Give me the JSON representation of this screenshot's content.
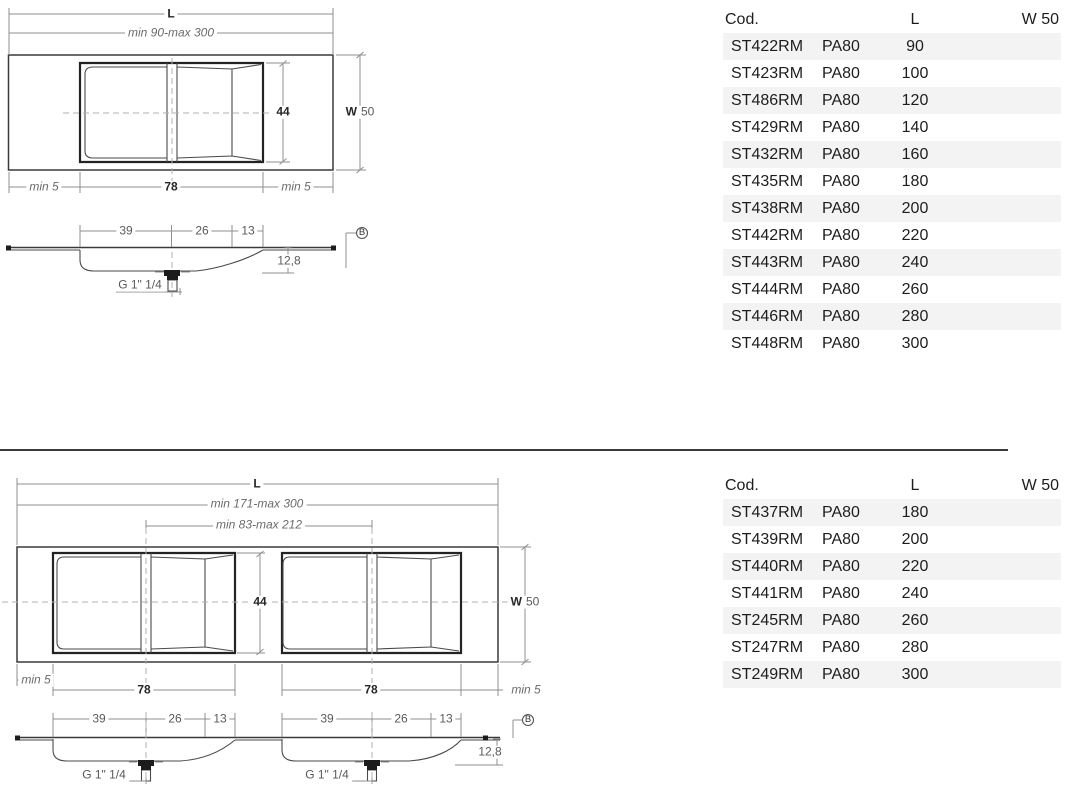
{
  "sections": [
    {
      "name": "single-basin",
      "drawing": {
        "plan": {
          "overall_length_label": "L",
          "length_range": "min 90-max 300",
          "basin_depth": "44",
          "width_label": "W",
          "width_value": "50",
          "left_margin": "min 5",
          "basin_width": "78",
          "right_margin": "min 5"
        },
        "section_view": {
          "dims": [
            "39",
            "26",
            "13"
          ],
          "thickness": "12,8",
          "drain_label": "G 1\" 1/4",
          "detail_callout": "B"
        }
      },
      "table": {
        "headers": {
          "code": "Cod.",
          "length": "L",
          "width": "W 50"
        },
        "rows": [
          {
            "code": "ST422RM",
            "series": "PA80",
            "length": "90"
          },
          {
            "code": "ST423RM",
            "series": "PA80",
            "length": "100"
          },
          {
            "code": "ST486RM",
            "series": "PA80",
            "length": "120"
          },
          {
            "code": "ST429RM",
            "series": "PA80",
            "length": "140"
          },
          {
            "code": "ST432RM",
            "series": "PA80",
            "length": "160"
          },
          {
            "code": "ST435RM",
            "series": "PA80",
            "length": "180"
          },
          {
            "code": "ST438RM",
            "series": "PA80",
            "length": "200"
          },
          {
            "code": "ST442RM",
            "series": "PA80",
            "length": "220"
          },
          {
            "code": "ST443RM",
            "series": "PA80",
            "length": "240"
          },
          {
            "code": "ST444RM",
            "series": "PA80",
            "length": "260"
          },
          {
            "code": "ST446RM",
            "series": "PA80",
            "length": "280"
          },
          {
            "code": "ST448RM",
            "series": "PA80",
            "length": "300"
          }
        ]
      }
    },
    {
      "name": "double-basin",
      "drawing": {
        "plan": {
          "overall_length_label": "L",
          "length_range": "min 171-max 300",
          "centers_range": "min 83-max 212",
          "basin_depth": "44",
          "width_label": "W",
          "width_value": "50",
          "left_margin": "min 5",
          "basin1_width": "78",
          "basin2_width": "78",
          "right_margin": "min 5"
        },
        "section_view": {
          "dims1": [
            "39",
            "26",
            "13"
          ],
          "dims2": [
            "39",
            "26",
            "13"
          ],
          "thickness": "12,8",
          "drain1_label": "G 1\" 1/4",
          "drain2_label": "G 1\" 1/4",
          "detail_callout": "B"
        }
      },
      "table": {
        "headers": {
          "code": "Cod.",
          "length": "L",
          "width": "W 50"
        },
        "rows": [
          {
            "code": "ST437RM",
            "series": "PA80",
            "length": "180"
          },
          {
            "code": "ST439RM",
            "series": "PA80",
            "length": "200"
          },
          {
            "code": "ST440RM",
            "series": "PA80",
            "length": "220"
          },
          {
            "code": "ST441RM",
            "series": "PA80",
            "length": "240"
          },
          {
            "code": "ST245RM",
            "series": "PA80",
            "length": "260"
          },
          {
            "code": "ST247RM",
            "series": "PA80",
            "length": "280"
          },
          {
            "code": "ST249RM",
            "series": "PA80",
            "length": "300"
          }
        ]
      }
    }
  ]
}
